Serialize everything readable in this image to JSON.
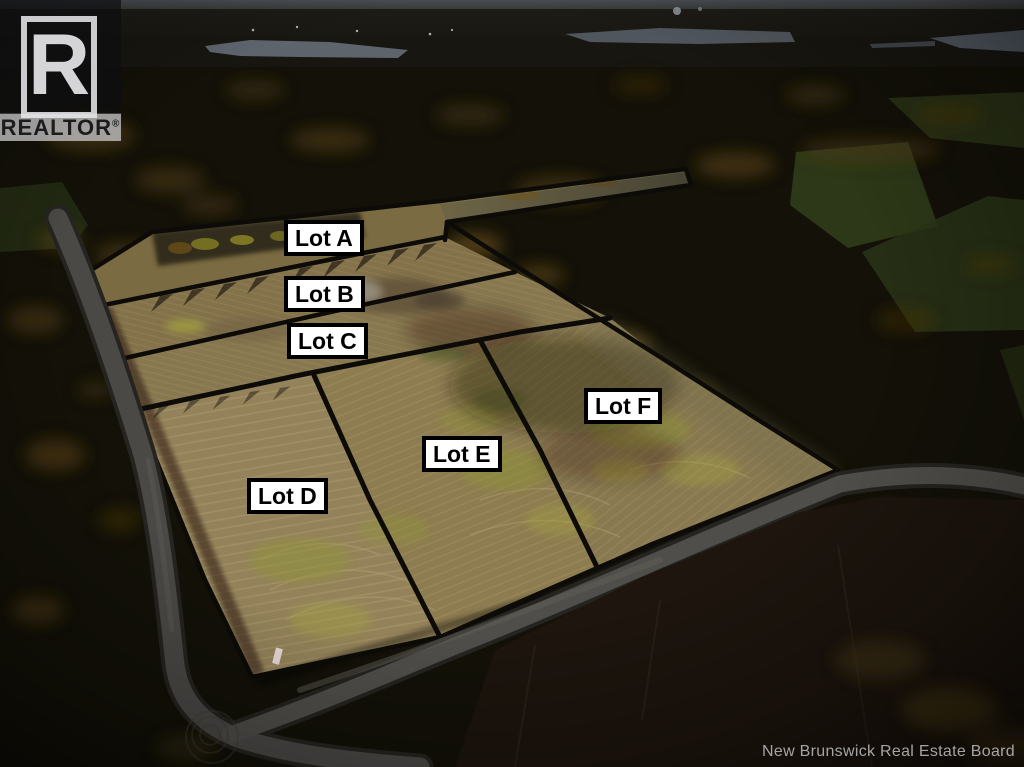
{
  "watermark": {
    "logo_letter": "R",
    "brand": "REALTOR",
    "registered": "®"
  },
  "lots": [
    {
      "id": "lot-a",
      "label": "Lot A"
    },
    {
      "id": "lot-b",
      "label": "Lot B"
    },
    {
      "id": "lot-c",
      "label": "Lot C"
    },
    {
      "id": "lot-d",
      "label": "Lot D"
    },
    {
      "id": "lot-e",
      "label": "Lot E"
    },
    {
      "id": "lot-f",
      "label": "Lot F"
    }
  ],
  "attribution": "New Brunswick Real Estate Board",
  "scene": {
    "description": "Dusk aerial drone photo of a cleared farm field subdivided into six surveyed lots, surrounded by autumn forest, rural gravel roads and distant lakes",
    "colors": {
      "field_tan": "#8d7c50",
      "lot_line_black": "#0c0b08",
      "label_background": "#ffffff",
      "label_border": "#000000",
      "label_text": "#000000",
      "forest_dark": "#141209",
      "autumn_amber": "#5f4515",
      "road_gray": "#4b4946",
      "lake_gray": "#5d646c",
      "sky_band": "#4a4e54",
      "watermark_text": "#e8e8e8",
      "attribution_text": "#b9b9b9"
    }
  }
}
